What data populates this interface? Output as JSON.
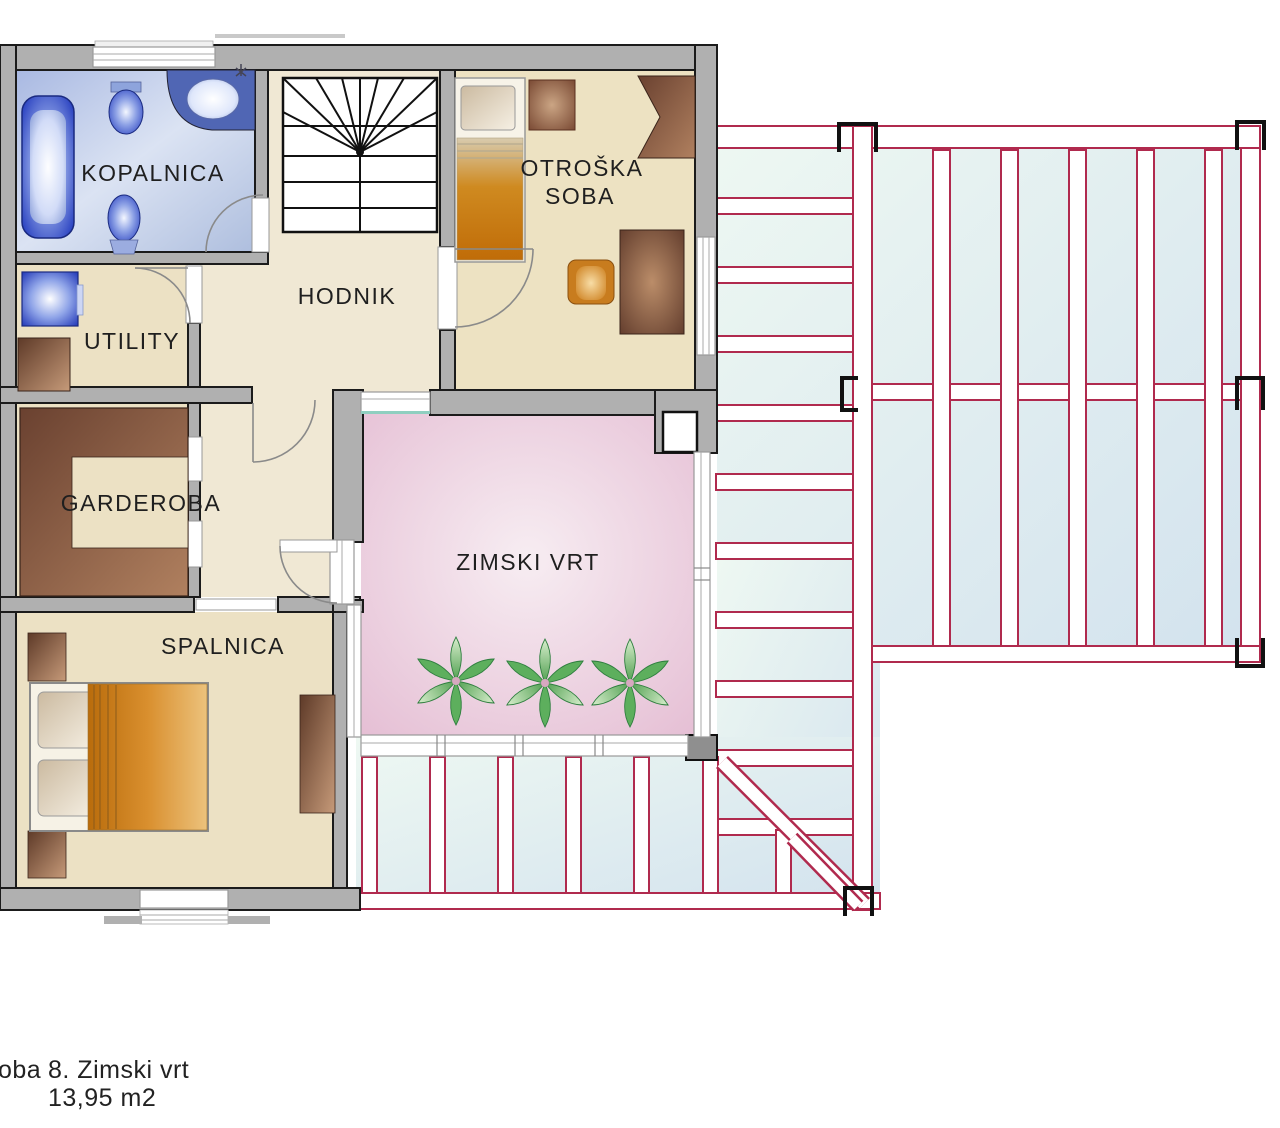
{
  "rooms": {
    "kopalnica": "KOPALNICA",
    "utility": "UTILITY",
    "hodnik": "HODNIK",
    "otroska_line1": "OTROŠKA",
    "otroska_line2": "SOBA",
    "garderoba": "GARDEROBA",
    "spalnica": "SPALNICA",
    "zimski_vrt": "ZIMSKI VRT"
  },
  "legend": {
    "truncated_prefix": "oba",
    "entry": "8. Zimski vrt",
    "area": "13,95  m2"
  },
  "colors": {
    "wall_gray": "#b0b0b0",
    "outline": "#1b1b1b",
    "floor_beige": "#ece1c4",
    "hallway_beige": "#f0e8d4",
    "bathroom_blue": "#b7c6e6",
    "winter_garden_pink": "#e9c6d9",
    "glass_cyan": "#dceeea",
    "pergola_frame_red": "#b02a4e",
    "fixture_blue": "#2840c0",
    "furniture_brown": "#7a4f38",
    "bed_orange": "#cc7a14",
    "plant_green": "#57a857"
  }
}
